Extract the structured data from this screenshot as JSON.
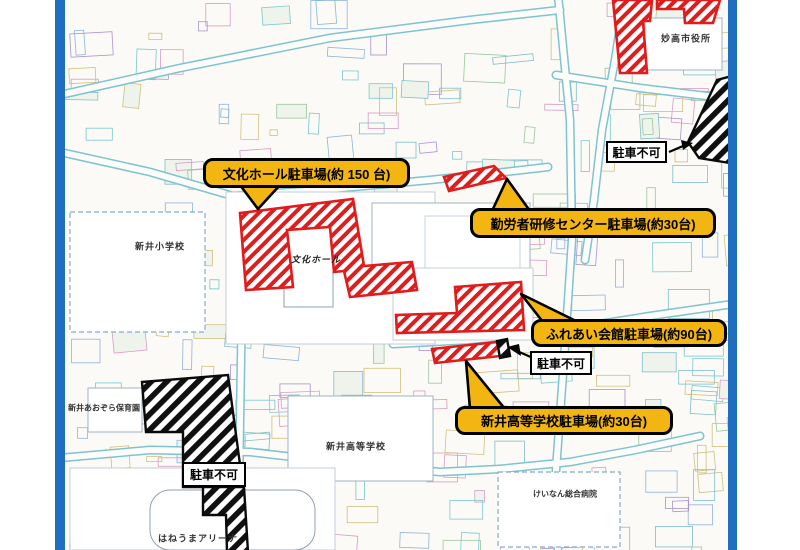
{
  "colors": {
    "frame_blue": "#1e6fc0",
    "bubble_yellow": "#f2b512",
    "parking_red": "#e11c1c",
    "no_parking_black": "#0a0a0a"
  },
  "parking_bubbles": [
    {
      "label": "文化ホール駐車場(約 150 台)"
    },
    {
      "label": "勤労者研修センター駐車場(約30台)"
    },
    {
      "label": "ふれあい会館駐車場(約90台)"
    },
    {
      "label": "新井高等学校駐車場(約30台)"
    }
  ],
  "no_parking_label": "駐車不可",
  "facilities": [
    {
      "name": "新井小学校"
    },
    {
      "name": "文化ホール"
    },
    {
      "name": "新井高等学校"
    },
    {
      "name": "新井あおぞら保育園"
    },
    {
      "name": "妙高市役所"
    },
    {
      "name": "けいなん総合病院"
    },
    {
      "name": "はねうまアリーナ"
    }
  ]
}
